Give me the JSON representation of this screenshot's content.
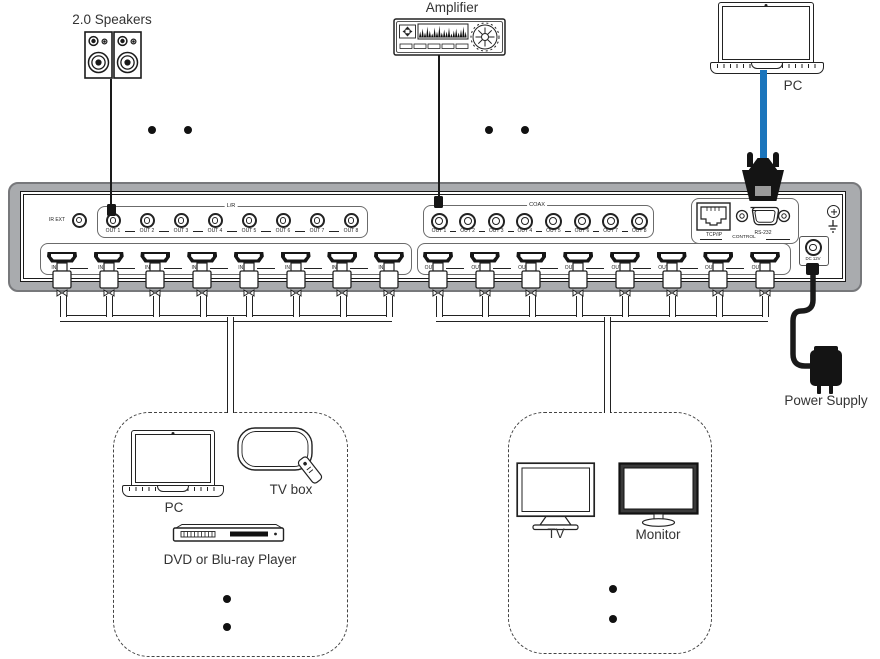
{
  "colors": {
    "chassis_gray": "#a9abae",
    "line_black": "#1a1a1a",
    "blue_cable": "#1b75bc"
  },
  "top": {
    "speakers_label": "2.0 Speakers",
    "amplifier_label": "Amplifier",
    "pc_label": "PC"
  },
  "device": {
    "ir_ext_label": "IR EXT",
    "analog_audio": {
      "group_label": "L/R",
      "ports": [
        "OUT 1",
        "OUT 2",
        "OUT 3",
        "OUT 4",
        "OUT 5",
        "OUT 6",
        "OUT 7",
        "OUT 8"
      ]
    },
    "coax_audio": {
      "group_label": "COAX",
      "ports": [
        "OUT 1",
        "OUT 2",
        "OUT 3",
        "OUT 4",
        "OUT 5",
        "OUT 6",
        "OUT 7",
        "OUT 8"
      ]
    },
    "control": {
      "group_label": "CONTROL",
      "tcpip_label": "TCP/IP",
      "rs232_label": "RS-232"
    },
    "hdmi_inputs": {
      "ports": [
        "IN 1",
        "IN 2",
        "IN 3",
        "IN 4",
        "IN 5",
        "IN 6",
        "IN 7",
        "IN 8"
      ]
    },
    "hdmi_outputs": {
      "ports": [
        "OUT 1",
        "OUT 2",
        "OUT 3",
        "OUT 4",
        "OUT 5",
        "OUT 6",
        "OUT 7",
        "OUT 8"
      ]
    },
    "dc_label": "DC 12V"
  },
  "bottom": {
    "power_supply_label": "Power Supply",
    "sources_box": {
      "pc_label": "PC",
      "tvbox_label": "TV box",
      "dvd_label": "DVD or Blu-ray Player"
    },
    "displays_box": {
      "tv_label": "TV",
      "monitor_label": "Monitor"
    }
  },
  "icons": {
    "speakers": "speakers-icon",
    "amplifier": "amplifier-icon",
    "laptop": "laptop-icon",
    "tv": "tv-icon",
    "monitor": "monitor-icon",
    "tvbox": "tvbox-icon",
    "dvd": "dvd-player-icon",
    "power_supply": "power-adapter-icon",
    "ground": "ground-icon",
    "screw": "screw-icon"
  }
}
